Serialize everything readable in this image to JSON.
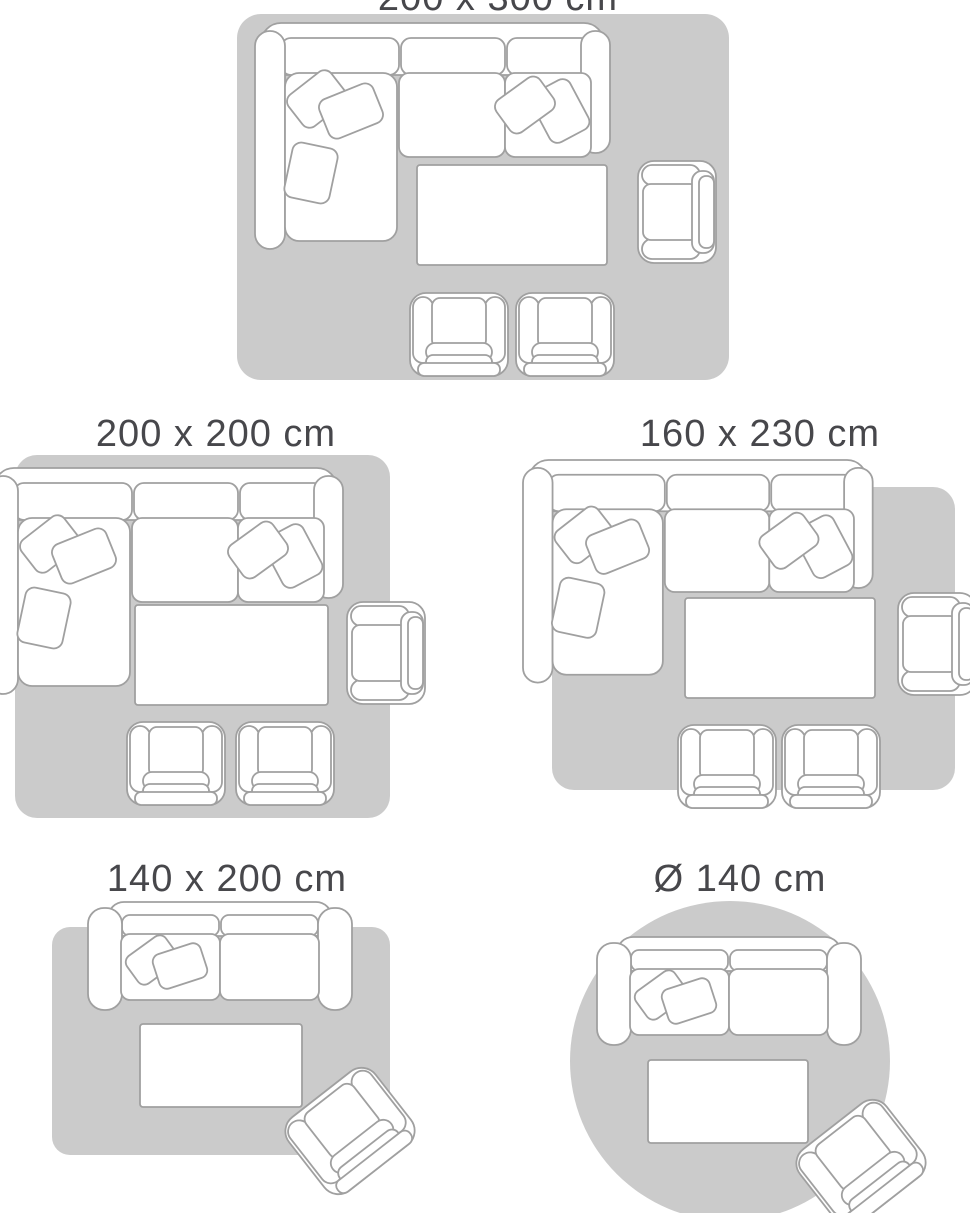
{
  "colors": {
    "background": "#ffffff",
    "rug_fill": "#cbcbcb",
    "furniture_outline": "#a0a0a0",
    "furniture_fill": "#ffffff",
    "label_text": "#47474b"
  },
  "panels": [
    {
      "id": "rug-200x300",
      "label": "200 x 300 cm",
      "rug_shape": "rectangle",
      "width_cm": 200,
      "length_cm": 300,
      "furniture": [
        "corner-sofa",
        "scatter-cushions",
        "coffee-table",
        "armchair-side",
        "armchair-front",
        "armchair-front"
      ]
    },
    {
      "id": "rug-200x200",
      "label": "200 x 200 cm",
      "rug_shape": "square",
      "width_cm": 200,
      "length_cm": 200,
      "furniture": [
        "corner-sofa",
        "scatter-cushions",
        "coffee-table",
        "armchair-side",
        "armchair-front",
        "armchair-front"
      ]
    },
    {
      "id": "rug-160x230",
      "label": "160 x 230 cm",
      "rug_shape": "rectangle",
      "width_cm": 160,
      "length_cm": 230,
      "furniture": [
        "corner-sofa",
        "scatter-cushions",
        "coffee-table",
        "armchair-side",
        "armchair-front",
        "armchair-front"
      ]
    },
    {
      "id": "rug-140x200",
      "label": "140 x 200 cm",
      "rug_shape": "rectangle",
      "width_cm": 140,
      "length_cm": 200,
      "furniture": [
        "two-seat-sofa",
        "scatter-cushions",
        "coffee-table",
        "armchair-angled"
      ]
    },
    {
      "id": "rug-round-140",
      "label": "Ø 140 cm",
      "rug_shape": "circle",
      "diameter_cm": 140,
      "furniture": [
        "two-seat-sofa",
        "scatter-cushions",
        "coffee-table",
        "armchair-angled"
      ]
    }
  ]
}
